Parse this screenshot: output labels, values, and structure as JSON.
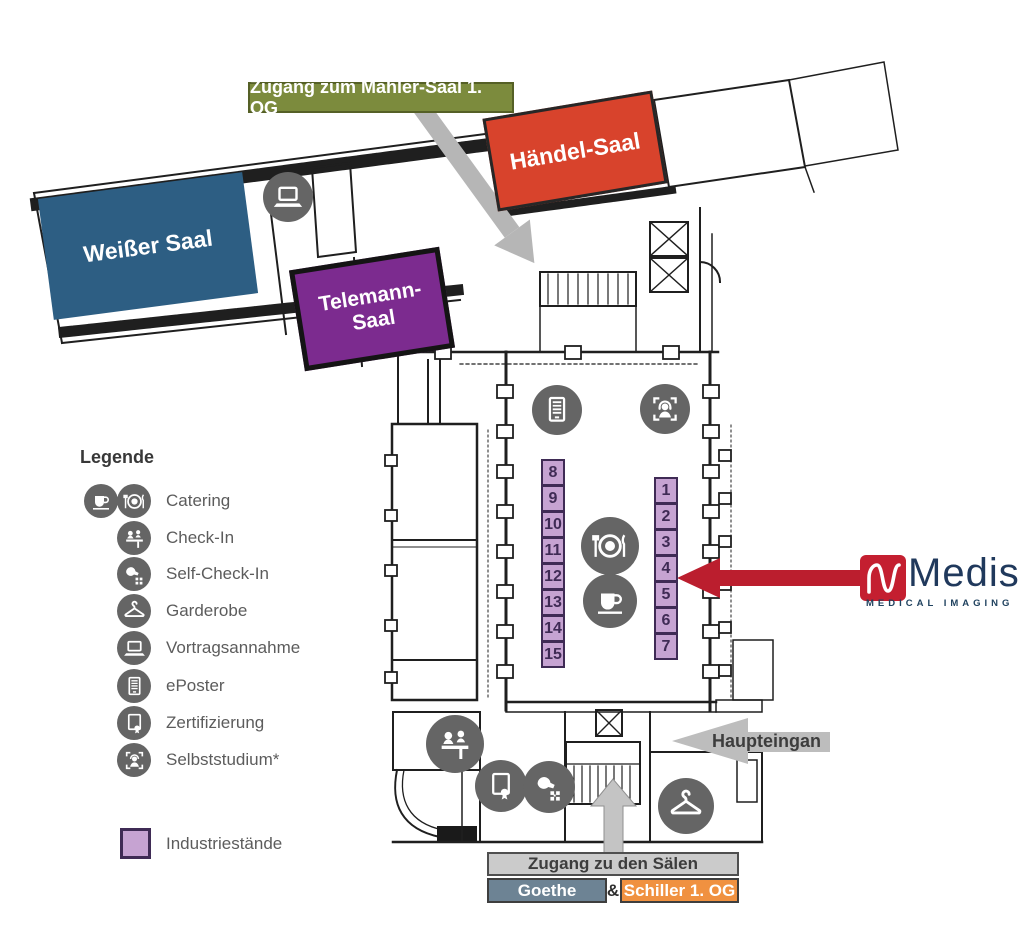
{
  "banner": {
    "mahler": "Zugang zum Mahler-Saal 1. OG"
  },
  "rooms": {
    "weisser": "Weißer Saal",
    "telemann": "Telemann-Saal",
    "haendel": "Händel-Saal"
  },
  "legend": {
    "title": "Legende",
    "items": [
      {
        "label": "Catering",
        "icon": "coffee-cup + plate-cutlery"
      },
      {
        "label": "Check-In",
        "icon": "people-at-desk"
      },
      {
        "label": "Self-Check-In",
        "icon": "hand-qr-code"
      },
      {
        "label": "Garderobe",
        "icon": "coat-hanger"
      },
      {
        "label": "Vortragsannahme",
        "icon": "laptop"
      },
      {
        "label": "ePoster",
        "icon": "document-lines"
      },
      {
        "label": "Zertifizierung",
        "icon": "certificate-seal"
      },
      {
        "label": "Selbststudium*",
        "icon": "person-headphones"
      }
    ],
    "industry_label": "Industriestände"
  },
  "stands": {
    "left": [
      "8",
      "9",
      "10",
      "11",
      "12",
      "13",
      "14",
      "15"
    ],
    "right": [
      "1",
      "2",
      "3",
      "4",
      "5",
      "6",
      "7"
    ]
  },
  "arrows": {
    "haupteingang_label": "Haupteingan"
  },
  "access": {
    "saele": "Zugang zu den Sälen",
    "goethe": "Goethe",
    "ampersand": "&",
    "schiller": "Schiller 1. OG"
  },
  "logo": {
    "name": "Medis",
    "tagline": "MEDICAL IMAGING"
  },
  "colors": {
    "weisser_blue": "#2d5e83",
    "telemann_purple": "#7c2b8f",
    "haendel_red": "#d8432c",
    "banner_green": "#7c8b3d",
    "stand_fill": "#c6a3d2",
    "stand_border": "#3f2b55",
    "goethe_slate": "#6d8394",
    "schiller_orange": "#f09140",
    "medis_red": "#c41f30",
    "medis_navy": "#20395c",
    "red_arrow": "#bb1e2e",
    "gray_arrow": "#b6b6b6",
    "icon_gray": "#656565"
  }
}
